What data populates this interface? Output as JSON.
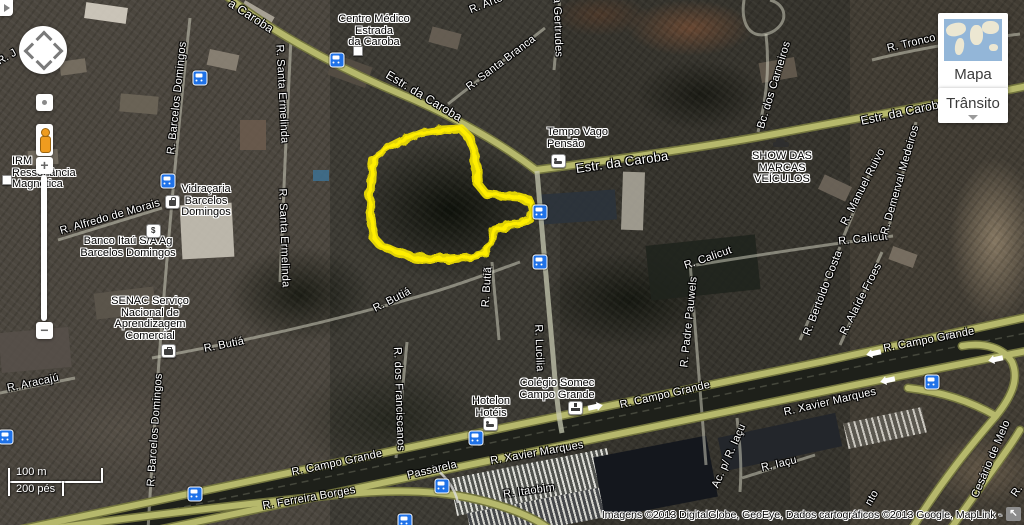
{
  "controls": {
    "map_type_button": "Mapa",
    "traffic_button": "Trânsito",
    "zoom_in": "+",
    "zoom_out": "−"
  },
  "scale_bar": {
    "metric": "100 m",
    "imperial": "200 pés"
  },
  "attribution": "Imagens ©2013 DigitalGlobe, GeoEye, Dados cartográficos ©2013 Google, MapLink -",
  "highlight": {
    "color": "#ffee00",
    "points": [
      [
        374,
        158
      ],
      [
        388,
        148
      ],
      [
        404,
        140
      ],
      [
        422,
        133
      ],
      [
        442,
        130
      ],
      [
        461,
        129
      ],
      [
        469,
        137
      ],
      [
        474,
        151
      ],
      [
        477,
        168
      ],
      [
        478,
        184
      ],
      [
        486,
        194
      ],
      [
        503,
        196
      ],
      [
        519,
        197
      ],
      [
        529,
        200
      ],
      [
        532,
        209
      ],
      [
        530,
        219
      ],
      [
        520,
        224
      ],
      [
        505,
        226
      ],
      [
        494,
        229
      ],
      [
        491,
        243
      ],
      [
        486,
        253
      ],
      [
        470,
        257
      ],
      [
        450,
        259
      ],
      [
        430,
        259
      ],
      [
        412,
        257
      ],
      [
        396,
        252
      ],
      [
        381,
        246
      ],
      [
        374,
        238
      ],
      [
        371,
        222
      ],
      [
        370,
        204
      ],
      [
        371,
        186
      ],
      [
        372,
        170
      ]
    ]
  },
  "street_labels": [
    {
      "text": "a Caroba",
      "x": 251,
      "y": 16,
      "rot": 33,
      "fs": 12
    },
    {
      "text": "Estr. da Caroba",
      "x": 424,
      "y": 96,
      "rot": 31,
      "fs": 12
    },
    {
      "text": "Estr. da Caroba",
      "x": 622,
      "y": 162,
      "rot": -8,
      "fs": 13
    },
    {
      "text": "Estr. da Caroba",
      "x": 903,
      "y": 112,
      "rot": -12,
      "fs": 12
    },
    {
      "text": "R. Tronco d",
      "x": 916,
      "y": 42,
      "rot": -13
    },
    {
      "text": "Bc. dos Carneiros",
      "x": 774,
      "y": 85,
      "rot": -73
    },
    {
      "text": "R. Santa Branca",
      "x": 501,
      "y": 63,
      "rot": -37
    },
    {
      "text": "R. Santa Gertrudes",
      "x": 557,
      "y": 8,
      "rot": 88
    },
    {
      "text": "R. Arte",
      "x": 486,
      "y": 4,
      "rot": -22
    },
    {
      "text": "R. J",
      "x": 7,
      "y": 57,
      "rot": -30
    },
    {
      "text": "R. Barcelos Domingos",
      "x": 177,
      "y": 98,
      "rot": -84
    },
    {
      "text": "R. Santa Ermelinda",
      "x": 282,
      "y": 94,
      "rot": 87
    },
    {
      "text": "R. Santa Ermelinda",
      "x": 284,
      "y": 238,
      "rot": 88
    },
    {
      "text": "R. Alfredo de Morais",
      "x": 110,
      "y": 217,
      "rot": -16
    },
    {
      "text": "R. Barcelos Domingos",
      "x": 155,
      "y": 430,
      "rot": -86
    },
    {
      "text": "R. Aracajú",
      "x": 33,
      "y": 383,
      "rot": -12
    },
    {
      "text": "R. Butiá",
      "x": 224,
      "y": 345,
      "rot": -11
    },
    {
      "text": "R. Butiá",
      "x": 392,
      "y": 300,
      "rot": -27
    },
    {
      "text": "R. Butiã",
      "x": 487,
      "y": 287,
      "rot": -86
    },
    {
      "text": "R. dos Franciscanos",
      "x": 399,
      "y": 399,
      "rot": 88
    },
    {
      "text": "R. Lucilia",
      "x": 539,
      "y": 348,
      "rot": 88
    },
    {
      "text": "R. Calicut",
      "x": 863,
      "y": 239,
      "rot": -6
    },
    {
      "text": "R. Calicut",
      "x": 708,
      "y": 258,
      "rot": -19
    },
    {
      "text": "R. Padre Pauwels",
      "x": 689,
      "y": 322,
      "rot": -84
    },
    {
      "text": "R. Bertoldo Costa",
      "x": 823,
      "y": 293,
      "rot": -69
    },
    {
      "text": "R. Alaíde Froes",
      "x": 861,
      "y": 299,
      "rot": -63
    },
    {
      "text": "R. Manuel Ruivo",
      "x": 863,
      "y": 187,
      "rot": -63
    },
    {
      "text": "R. Demerval Medeiros",
      "x": 900,
      "y": 180,
      "rot": -74
    },
    {
      "text": "R. Campo Grande",
      "x": 337,
      "y": 463,
      "rot": -12
    },
    {
      "text": "R. Campo Grande",
      "x": 665,
      "y": 395,
      "rot": -13
    },
    {
      "text": "R. Campo Grande",
      "x": 929,
      "y": 340,
      "rot": -11
    },
    {
      "text": "R. Xavier Marques",
      "x": 537,
      "y": 453,
      "rot": -10
    },
    {
      "text": "R. Xavier Marques",
      "x": 830,
      "y": 402,
      "rot": -13
    },
    {
      "text": "R. Ferreira Borges",
      "x": 309,
      "y": 498,
      "rot": -10
    },
    {
      "text": "R. Itaobim",
      "x": 529,
      "y": 491,
      "rot": -8
    },
    {
      "text": "R. Iaçu",
      "x": 779,
      "y": 464,
      "rot": -13
    },
    {
      "text": "Ac. p/ R. Iaçu",
      "x": 729,
      "y": 456,
      "rot": -66
    },
    {
      "text": "Cesário de Melo",
      "x": 991,
      "y": 459,
      "rot": -67
    },
    {
      "text": "Passarela",
      "x": 432,
      "y": 470,
      "rot": -13
    },
    {
      "text": "nto",
      "x": 872,
      "y": 498,
      "rot": -60
    },
    {
      "text": "R.",
      "x": 1017,
      "y": 491,
      "rot": -55
    }
  ],
  "poi_labels": [
    {
      "lines": [
        "Centro Médico",
        "Estrada",
        "da Caroba"
      ],
      "x": 374,
      "y": 14,
      "align": "center",
      "icon": {
        "type": "square-icon",
        "x": 353,
        "y": 46
      }
    },
    {
      "lines": [
        "Tempo Vago",
        "Pensão"
      ],
      "x": 547,
      "y": 127,
      "align": "left",
      "icon": {
        "type": "bed-icon",
        "x": 551,
        "y": 154
      }
    },
    {
      "lines": [
        "SHOW DAS",
        "MARCAS",
        "VEÍCULOS"
      ],
      "x": 782,
      "y": 151,
      "align": "center",
      "icon": {
        "type": "car-icon",
        "x": 773,
        "y": 137
      }
    },
    {
      "lines": [
        "Vidraçaria",
        "Barcelos",
        "Domingos"
      ],
      "x": 206,
      "y": 184,
      "align": "center",
      "icon": {
        "type": "bag-icon",
        "x": 165,
        "y": 195
      }
    },
    {
      "lines": [
        "Banco Itaú S/A Ag",
        "Barcelos Domingos"
      ],
      "x": 128,
      "y": 236,
      "align": "center",
      "icon": {
        "type": "bank-icon",
        "x": 146,
        "y": 224
      }
    },
    {
      "lines": [
        "IRM",
        "Ressonância",
        "Magnética"
      ],
      "x": 12,
      "y": 156,
      "align": "left",
      "icon": {
        "type": "square-icon",
        "x": 2,
        "y": 175
      }
    },
    {
      "lines": [
        "SENAC Serviço",
        "Nacional de",
        "Aprendizagem",
        "Comercial"
      ],
      "x": 150,
      "y": 296,
      "align": "center",
      "icon": {
        "type": "case-icon",
        "x": 161,
        "y": 344
      }
    },
    {
      "lines": [
        "Colégio Somec",
        "Campo Grande"
      ],
      "x": 557,
      "y": 378,
      "align": "center",
      "icon": {
        "type": "school-icon",
        "x": 568,
        "y": 401
      }
    },
    {
      "lines": [
        "Hotelon",
        "Hotéis"
      ],
      "x": 491,
      "y": 396,
      "align": "center",
      "icon": {
        "type": "bed-icon",
        "x": 483,
        "y": 417
      }
    }
  ],
  "transit_stops": [
    {
      "x": 200,
      "y": 78
    },
    {
      "x": 337,
      "y": 60
    },
    {
      "x": 168,
      "y": 181
    },
    {
      "x": 540,
      "y": 212
    },
    {
      "x": 540,
      "y": 262
    },
    {
      "x": 476,
      "y": 438
    },
    {
      "x": 442,
      "y": 486
    },
    {
      "x": 405,
      "y": 521
    },
    {
      "x": 932,
      "y": 382
    },
    {
      "x": 6,
      "y": 437
    },
    {
      "x": 195,
      "y": 494
    }
  ],
  "road_arrows": [
    {
      "x": 594,
      "y": 407,
      "rot": -12
    },
    {
      "x": 875,
      "y": 353,
      "rot": 168
    },
    {
      "x": 997,
      "y": 359,
      "rot": 168
    },
    {
      "x": 889,
      "y": 380,
      "rot": 168
    },
    {
      "x": 948,
      "y": 336,
      "rot": -12
    }
  ]
}
